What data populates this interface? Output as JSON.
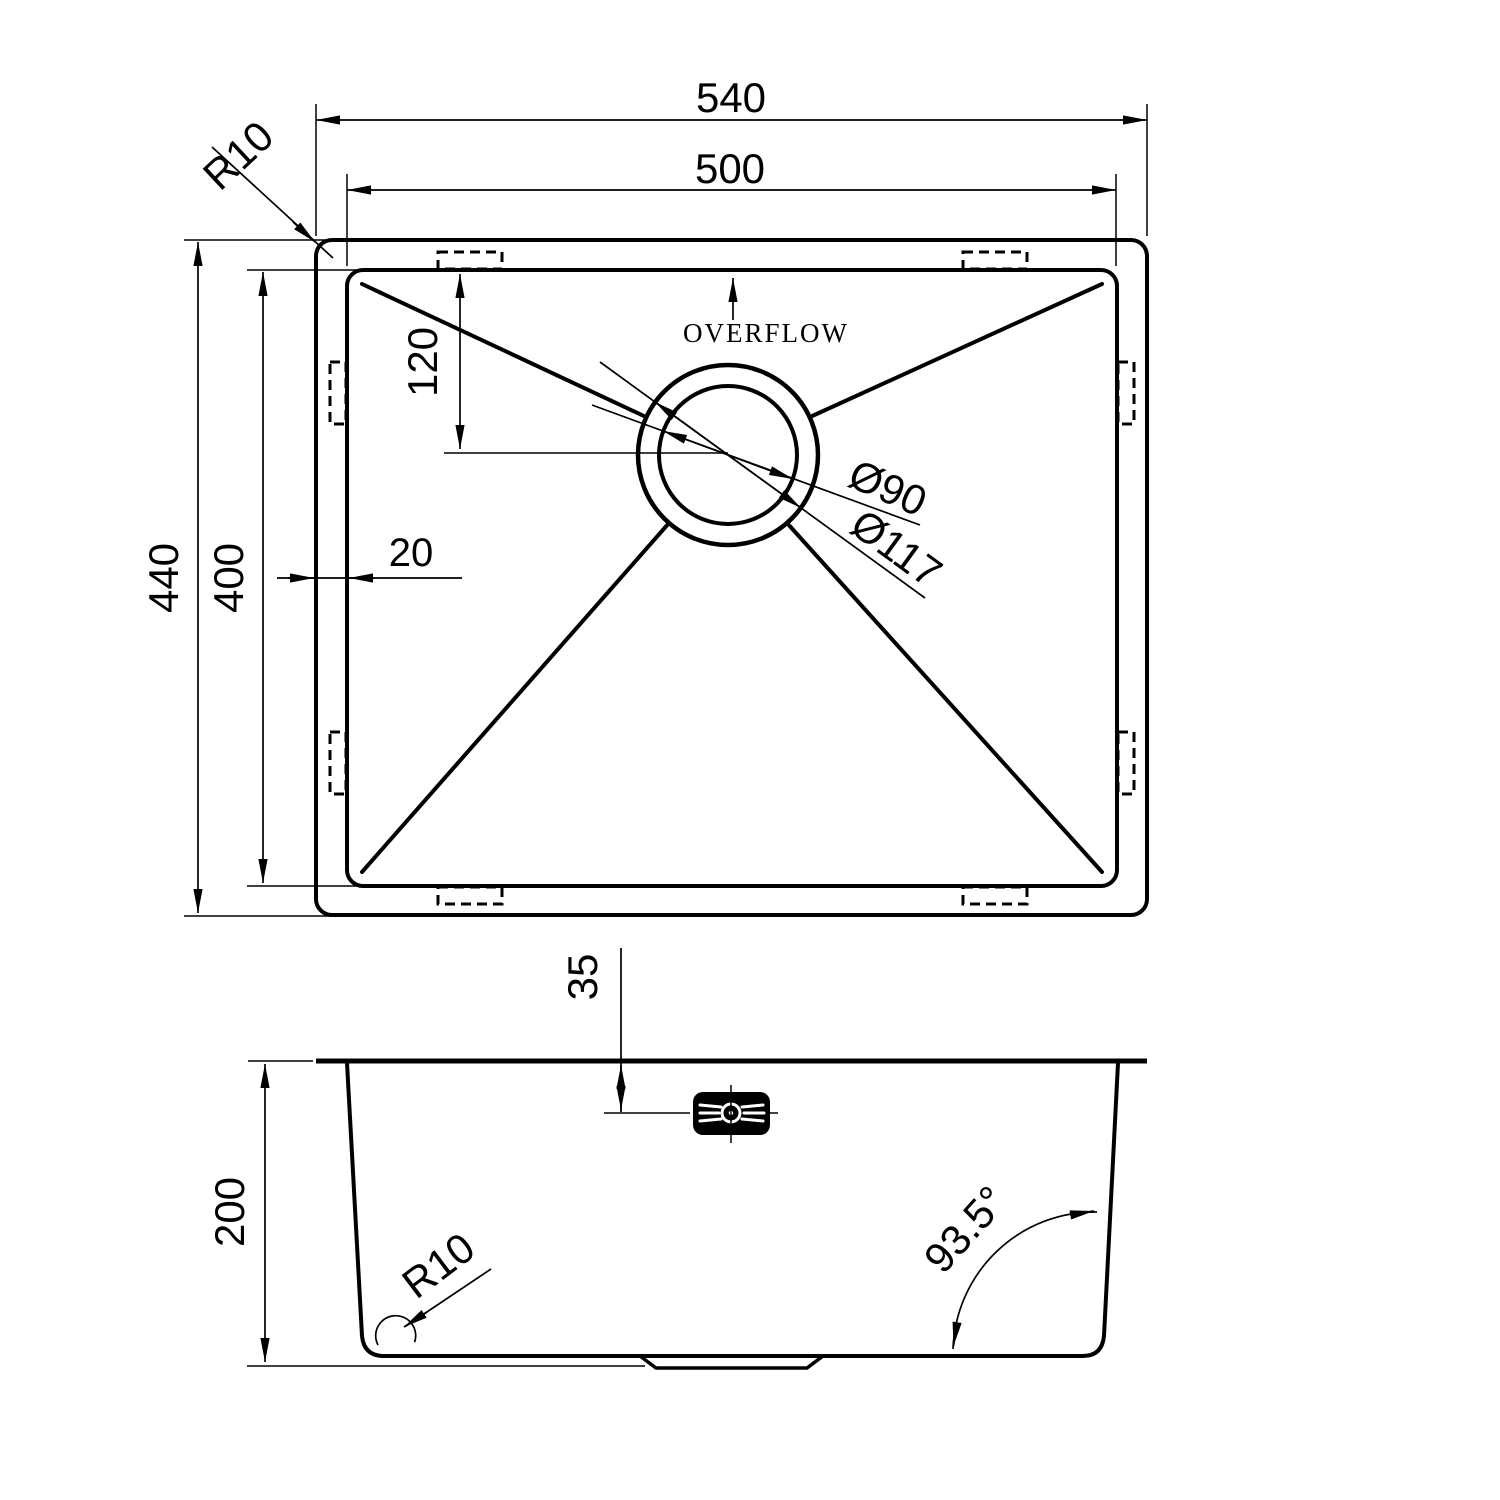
{
  "drawing": {
    "background_color": "#ffffff",
    "line_color": "#000000",
    "top_view": {
      "overall_width": "540",
      "basin_width": "500",
      "corner_radius": "R10",
      "overall_depth": "440",
      "basin_depth": "400",
      "drain_offset_from_top": "120",
      "rim_width": "20",
      "overflow_label": "OVERFLOW",
      "drain_hole_diameter": "Ø90",
      "drain_flange_diameter": "Ø117"
    },
    "side_view": {
      "overflow_center_depth": "35",
      "bowl_depth": "200",
      "bottom_corner_radius": "R10",
      "wall_angle": "93.5°"
    }
  }
}
